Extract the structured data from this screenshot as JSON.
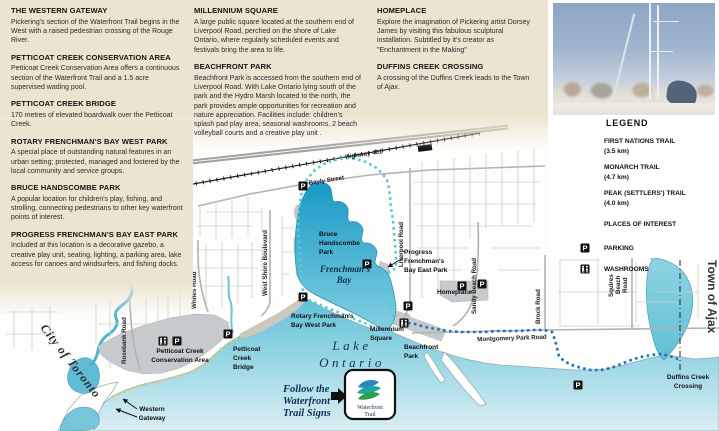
{
  "articles": [
    {
      "title": "THE WESTERN GATEWAY",
      "body": "Pickering's section of the Waterfront Trail begins in the West with a raised pedestrian crossing of the Rouge River."
    },
    {
      "title": "PETTICOAT CREEK CONSERVATION AREA",
      "body": "Petticoat Creek Conservation Area offers a continuous section of the Waterfront Trail and a 1.5 acre supervised wading pool."
    },
    {
      "title": "PETTICOAT CREEK BRIDGE",
      "body": "170 metres of elevated boardwalk over the Petticoat Creek."
    },
    {
      "title": "ROTARY FRENCHMAN'S BAY WEST PARK",
      "body": "A special place of outstanding natural features in an urban setting; protected, managed and fostered by the local community and service groups."
    },
    {
      "title": "BRUCE HANDSCOMBE PARK",
      "body": "A popular location for children's play, fishing, and strolling, connecting pedestrians to other key waterfront points of interest."
    },
    {
      "title": "PROGRESS FRENCHMAN'S BAY EAST PARK",
      "body": "Included at this location is a decorative gazebo, a creative play unit, seating, lighting, a parking area, lake access for canoes and windsurfers, and fishing docks."
    },
    {
      "title": "MILLENNIUM SQUARE",
      "body": "A large public square located at the southern end of Liverpool Road, perched on the shore of Lake Ontario, where regularly scheduled events and festivals bring the area to life."
    },
    {
      "title": "BEACHFRONT PARK",
      "body": "Beachfront Park is accessed from the southern end of Liverpool Road.  With Lake Ontario lying south of the park and the Hydro Marsh located to the north, the park provides ample opportunities for recreation and nature appreciation.  Facilities include: children's splash pad play area, seasonal washrooms, 2 beach volleyball courts and a creative play unit ."
    },
    {
      "title": "HOMEPLACE",
      "body": "Explore the imagination of Pickering artist Dorsey James by visiting this fabulous sculptural installation. Subtitled by it's creator as \"Enchantment in the Making\""
    },
    {
      "title": "DUFFINS CREEK CROSSING",
      "body": "A crossing of the Duffins Creek leads to the Town of Ajax."
    }
  ],
  "legend": {
    "title": "LEGEND",
    "trails": [
      {
        "name": "FIRST NATIONS TRAIL",
        "distance": "(3.5 km)",
        "color": "#d9c87d"
      },
      {
        "name": "MONARCH TRAIL",
        "distance": "(4.7 km)",
        "color": "#6fcfdc"
      },
      {
        "name": "PEAK (SETTLERS') TRAIL",
        "distance": "(4.0 km)",
        "color": "#1e6db6"
      }
    ],
    "places_label": "PLACES OF INTEREST",
    "places_color": "#c9cdd0",
    "parking_label": "PARKING",
    "washrooms_label": "WASHROOMS"
  },
  "map": {
    "regions": {
      "west": "City of Toronto",
      "east": "Town of Ajax"
    },
    "water": {
      "lake": [
        "Lake",
        "Ontario"
      ],
      "bay": [
        "Frenchman's",
        "Bay"
      ]
    },
    "roads": {
      "highway": "Highway 401",
      "bayly": "Bayly Street",
      "whites": "Whites Road",
      "rosebank": "Rosebank Road",
      "west_shore": "West Shore Boulevard",
      "liverpool": "Liverpool Road",
      "sandy_beach": "Sandy Beach Road",
      "brock": "Brock Road",
      "montgomery": "Montgomery Park Road",
      "squires": [
        "Squires",
        "Beach",
        "Road"
      ]
    },
    "places": {
      "western_gateway": [
        "Western",
        "Gateway"
      ],
      "petticoat_conservation": [
        "Petticoat Creek",
        "Conservation Area"
      ],
      "petticoat_bridge": [
        "Petticoat",
        "Creek",
        "Bridge"
      ],
      "rotary": [
        "Rotary Frenchman's",
        "Bay West Park"
      ],
      "bruce": [
        "Bruce",
        "Handscombe",
        "Park"
      ],
      "progress": [
        "Progress",
        "Frenchman's",
        "Bay East Park"
      ],
      "millennium": [
        "Millennium",
        "Square"
      ],
      "beachfront": [
        "Beachfront",
        "Park"
      ],
      "homeplace": "Homeplace",
      "duffins": [
        "Duffins Creek",
        "Crossing"
      ]
    },
    "follow_sign": [
      "Follow the",
      "Waterfront",
      "Trail Signs"
    ],
    "trail_sign": [
      "Waterfront",
      "Trail"
    ],
    "parking_glyph": "P",
    "colors": {
      "first_nations_trail": "#d9c87d",
      "monarch_trail": "#5ac8d8",
      "peak_trail": "#1e6fbd",
      "bay_water": "#1899c6",
      "lake_water": "#57bed6",
      "places_of_interest": "#c6cacc",
      "background_beige": "#ece4d0"
    }
  }
}
